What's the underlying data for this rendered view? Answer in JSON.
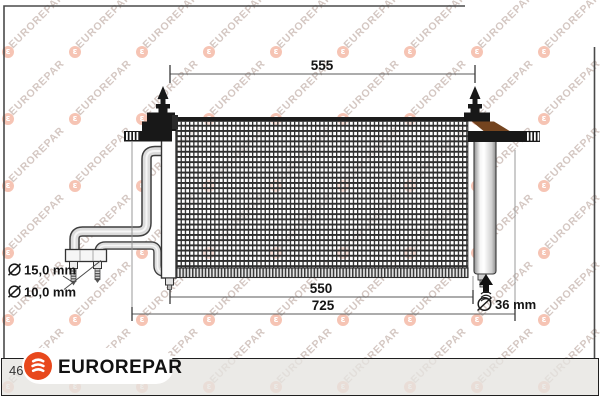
{
  "watermark": {
    "text": "EUROREPAR",
    "glyph": "ε",
    "grid": {
      "start_x": 8,
      "start_y": 52,
      "pitch_x": 67,
      "pitch_y": 67,
      "cols": 9,
      "rows": 6
    },
    "circle_color": "rgba(238,148,118,0.55)",
    "text_color": "rgba(186,164,157,0.62)"
  },
  "diagram": {
    "part": "air-conditioning-condenser",
    "dimensions": {
      "dim_top": "555",
      "dim_core": "550",
      "dim_total": "725",
      "drier_diameter": "36 mm",
      "pipe_large_diameter": "15,0 mm",
      "pipe_small_diameter": "10,0 mm"
    }
  },
  "footer": {
    "page_number": "46",
    "brand": "EUROREPAR",
    "brand_color": "#e8481c"
  }
}
